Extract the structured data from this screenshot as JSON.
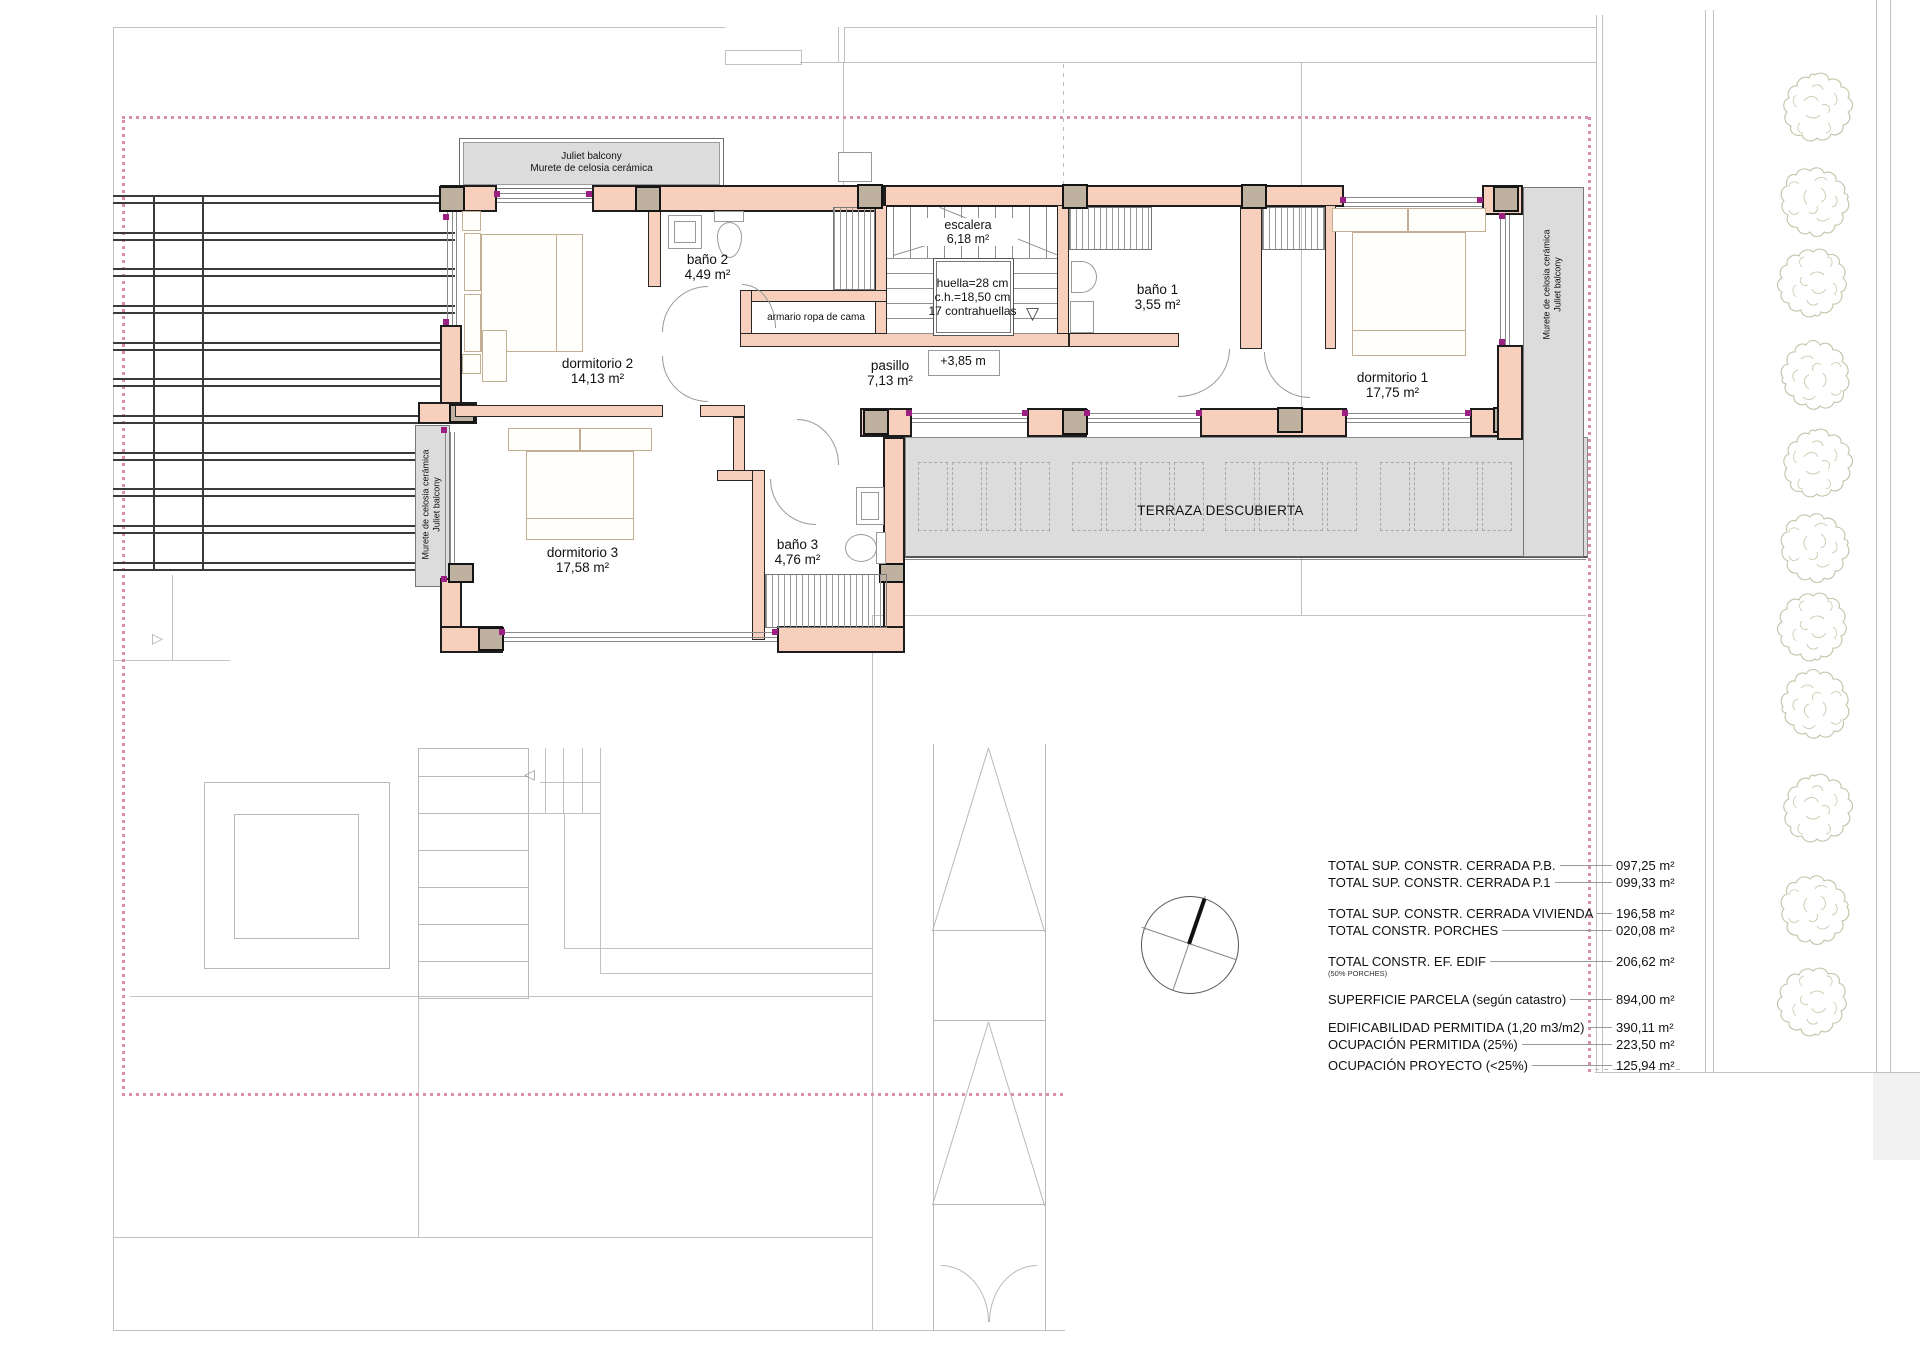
{
  "plan": {
    "rooms": {
      "dormitorio1": {
        "name": "dormitorio 1",
        "area": "17,75 m²"
      },
      "dormitorio2": {
        "name": "dormitorio 2",
        "area": "14,13 m²"
      },
      "dormitorio3": {
        "name": "dormitorio 3",
        "area": "17,58 m²"
      },
      "bano1": {
        "name": "baño 1",
        "area": "3,55 m²"
      },
      "bano2": {
        "name": "baño 2",
        "area": "4,49 m²"
      },
      "bano3": {
        "name": "baño 3",
        "area": "4,76 m²"
      },
      "pasillo": {
        "name": "pasillo",
        "area": "7,13 m²"
      },
      "escalera": {
        "name": "escalera",
        "area": "6,18 m²"
      },
      "terraza": {
        "name": "TERRAZA DESCUBIERTA"
      },
      "armario": {
        "name": "armario ropa de cama"
      }
    },
    "stairs": {
      "tread": "huella=28 cm",
      "riser": "c.h.=18,50 cm",
      "risers_count": "17 contrahuellas",
      "level": "+3,85 m"
    },
    "balconies": {
      "top_line1": "Juliet balcony",
      "top_line2": "Murete de celosia cerámica",
      "left_line1": "Murete de celosia cerámica",
      "left_line2": "Juliet balcony",
      "right_line1": "Murete de celosia cerámica",
      "right_line2": "Juliet balcony"
    }
  },
  "table": {
    "rows": [
      {
        "label": "TOTAL SUP. CONSTR. CERRADA P.B.",
        "value": "097,25 m²"
      },
      {
        "label": "TOTAL SUP. CONSTR. CERRADA P.1",
        "value": "099,33 m²"
      },
      {
        "label": "TOTAL SUP. CONSTR. CERRADA VIVIENDA",
        "value": "196,58 m²"
      },
      {
        "label": "TOTAL  CONSTR. PORCHES",
        "value": "020,08 m²"
      },
      {
        "label": "TOTAL  CONSTR.  EF. EDIF",
        "value": "206,62 m²",
        "note": "(50% PORCHES)"
      },
      {
        "label": "SUPERFICIE PARCELA (según catastro)",
        "value": "894,00 m²"
      },
      {
        "label": "EDIFICABILIDAD PERMITIDA (1,20 m3/m2)",
        "value": "390,11 m²"
      },
      {
        "label": "OCUPACIÓN PERMITIDA (25%)",
        "value": "223,50 m²"
      },
      {
        "label": "OCUPACIÓN PROYECTO (<25%)",
        "value": "125,94 m²"
      }
    ]
  },
  "colors": {
    "wall_fill": "#f6d0bd",
    "column_fill": "#bfb1a0",
    "terrace_fill": "#dcdcdc",
    "balcony_fill": "#dcdcdc",
    "boundary_dash": "#d890b0",
    "window_marker": "#9c1f82",
    "tree_stroke": "#a3b488"
  }
}
